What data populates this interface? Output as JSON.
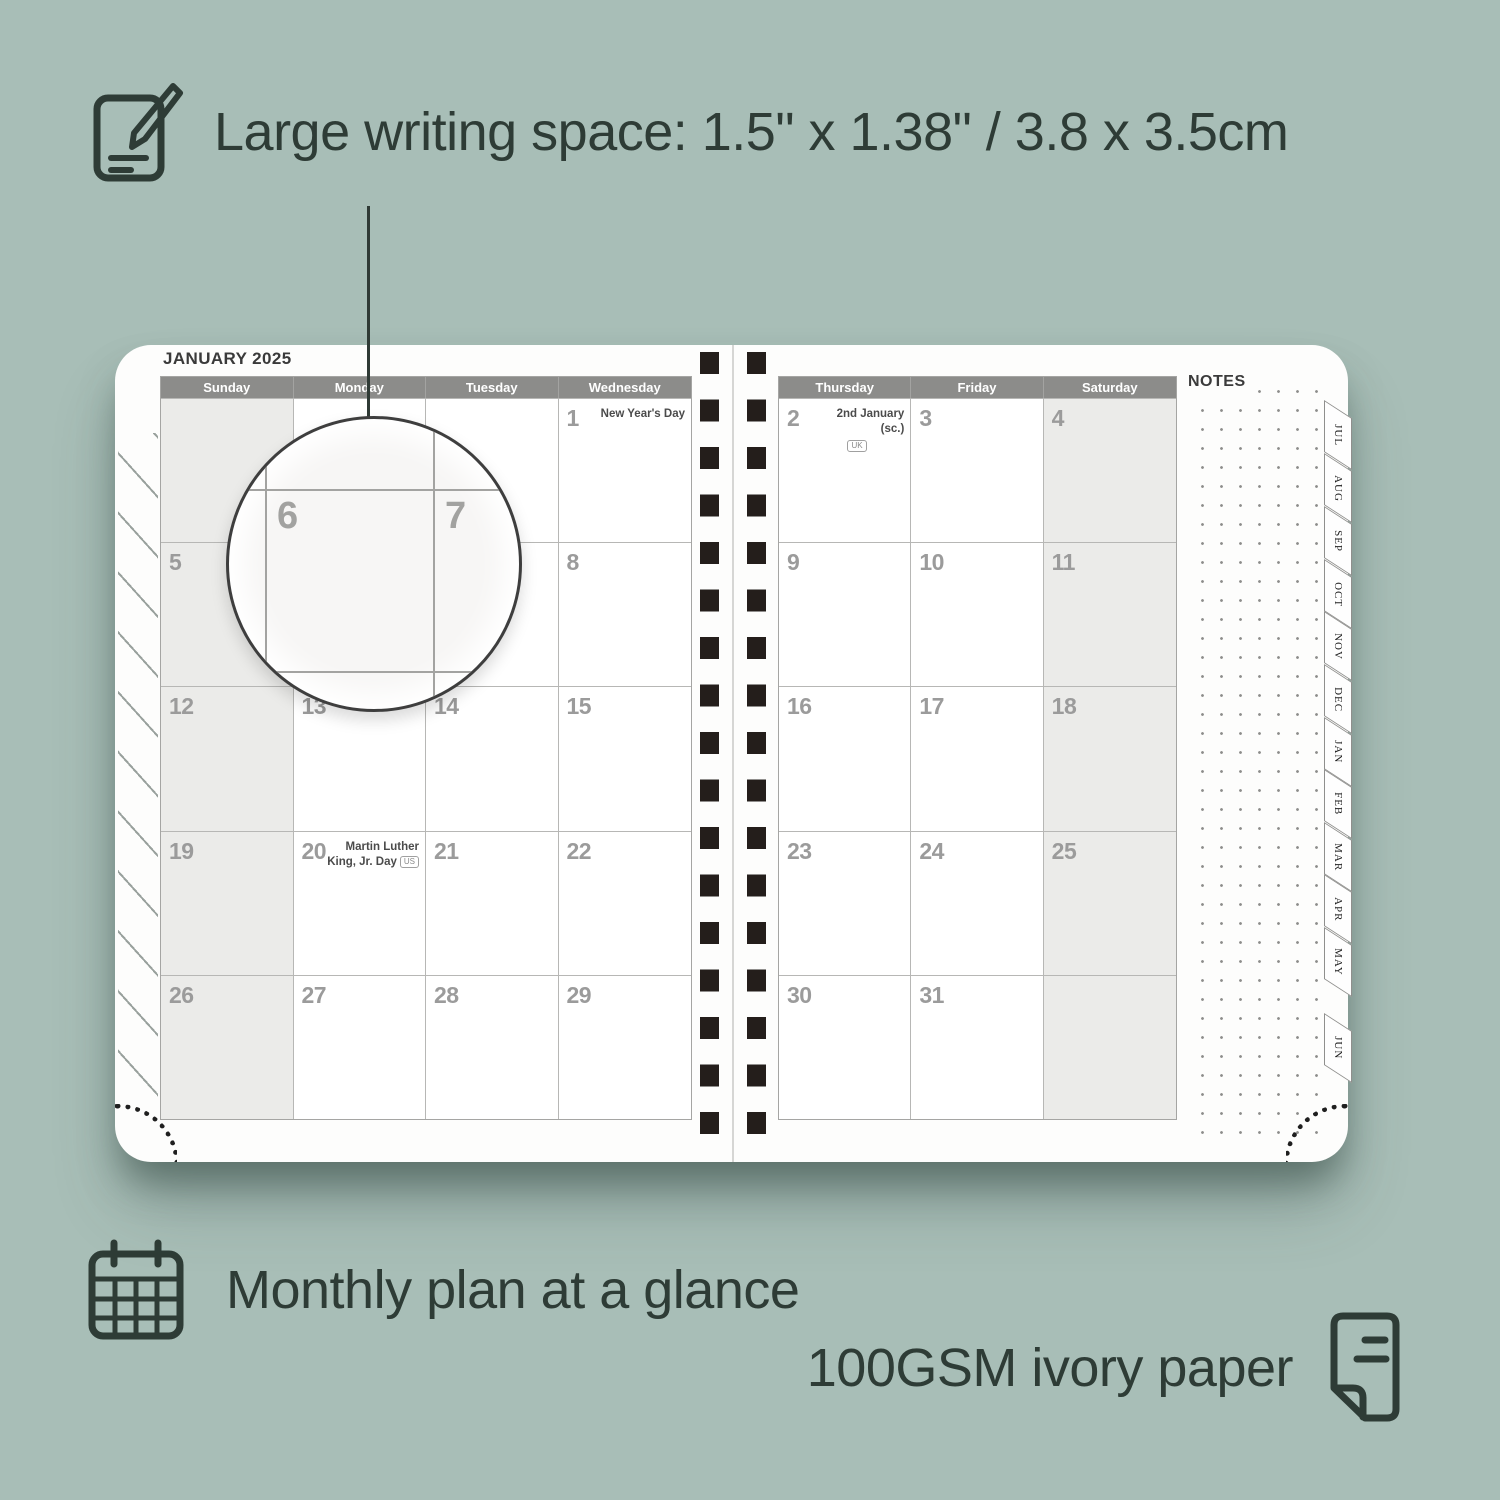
{
  "colors": {
    "background": "#a8beb7",
    "ink": "#2e3c36",
    "page": "#fdfdfc",
    "header_bar": "#8c8c8a",
    "weekend_fill": "#ebebe9",
    "grid_line": "#b7b7b5",
    "date_number": "#9b9b9b",
    "spiral": "#241e1b"
  },
  "features": {
    "writing_space": {
      "icon": "notepad-pencil-icon",
      "label": "Large writing space: 1.5\" x 1.38\" / 3.8 x 3.5cm"
    },
    "monthly_plan": {
      "icon": "calendar-grid-icon",
      "label": "Monthly plan at a glance"
    },
    "paper": {
      "icon": "paper-sheet-icon",
      "label": "100GSM ivory paper"
    }
  },
  "planner": {
    "month_title": "JANUARY 2025",
    "notes_label": "NOTES",
    "left_day_headers": [
      "Sunday",
      "Monday",
      "Tuesday",
      "Wednesday"
    ],
    "right_day_headers": [
      "Thursday",
      "Friday",
      "Saturday"
    ],
    "left_weeks": [
      [
        {
          "day": ""
        },
        {
          "day": ""
        },
        {
          "day": ""
        },
        {
          "day": "1",
          "holiday": "New Year's Day"
        }
      ],
      [
        {
          "day": "5"
        },
        {
          "day": "6"
        },
        {
          "day": "7"
        },
        {
          "day": "8"
        }
      ],
      [
        {
          "day": "12"
        },
        {
          "day": "13"
        },
        {
          "day": "14"
        },
        {
          "day": "15"
        }
      ],
      [
        {
          "day": "19"
        },
        {
          "day": "20",
          "holiday": "Martin Luther King, Jr. Day",
          "badge": "US",
          "badge_pos": "inline"
        },
        {
          "day": "21"
        },
        {
          "day": "22"
        }
      ],
      [
        {
          "day": "26"
        },
        {
          "day": "27"
        },
        {
          "day": "28"
        },
        {
          "day": "29"
        }
      ]
    ],
    "right_weeks": [
      [
        {
          "day": "2",
          "holiday": "2nd January (sc.)",
          "badge": "UK",
          "badge_pos": "below"
        },
        {
          "day": "3"
        },
        {
          "day": "4"
        }
      ],
      [
        {
          "day": "9"
        },
        {
          "day": "10"
        },
        {
          "day": "11"
        }
      ],
      [
        {
          "day": "16"
        },
        {
          "day": "17"
        },
        {
          "day": "18"
        }
      ],
      [
        {
          "day": "23"
        },
        {
          "day": "24"
        },
        {
          "day": "25"
        }
      ],
      [
        {
          "day": "30"
        },
        {
          "day": "31"
        },
        {
          "day": ""
        }
      ]
    ],
    "side_tabs": [
      "JUL",
      "AUG",
      "SEP",
      "OCT",
      "NOV",
      "DEC",
      "JAN",
      "FEB",
      "MAR",
      "APR",
      "MAY",
      "JUN"
    ],
    "magnifier": {
      "left_day": "6",
      "right_day": "7"
    }
  }
}
